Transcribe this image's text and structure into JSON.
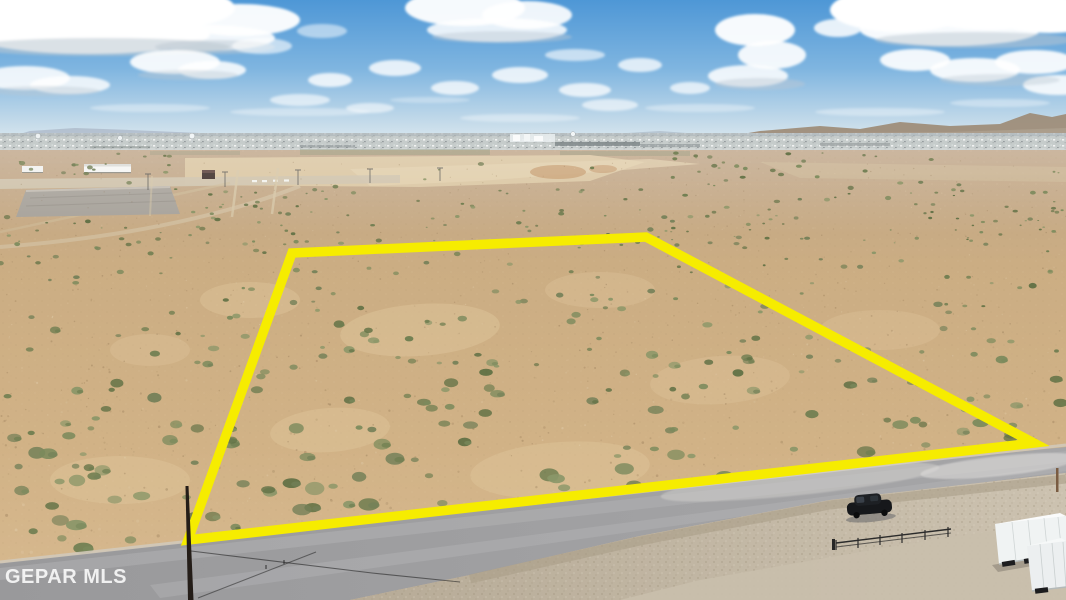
{
  "photo": {
    "alt": "aerial-drone-photo-of-vacant-desert-land-parcel",
    "width": 1066,
    "height": 600
  },
  "watermark": {
    "text": "GEPAR MLS",
    "color": "#ffffff",
    "opacity": 0.85
  },
  "parcel_outline": {
    "points": "292,253 646,237 1034,443 188,540",
    "color": "#F6EC00",
    "stroke_width": 9.5
  },
  "colors": {
    "sky_top": "#4E97D6",
    "sky_mid": "#7FB5E0",
    "sky_low": "#C7DCEA",
    "sky_horizon": "#E6EFF4",
    "cloud_white": "#FFFFFF",
    "cloud_shadow": "#BCC8D2",
    "mountain_left": "#9FA8BA",
    "mountain_right": "#9C8A74",
    "city_light": "#CDD3D5",
    "city_dark": "#B6BCBA",
    "sand_far": "#BFA588",
    "sand_mid": "#CBAD83",
    "sand_near": "#D7B98F",
    "cleared_pad": "#DAC5A0",
    "paved_pad": "#A7A29A",
    "road_asphalt_near": "#99999B",
    "road_asphalt_far": "#A6A6A8",
    "road_edge_dirt": "#D2C9BA",
    "gravel_shoulder": "#C2B6A2",
    "scrub_palette": [
      "#6E7D50",
      "#7B8A5C",
      "#5F7044",
      "#8A9668",
      "#748058"
    ],
    "speck_dark": "#8A6F4E",
    "speck_light": "#E8D7B8",
    "car_body": "#16181B",
    "trailer_white": "#F0F3F3",
    "pole_brown": "#241D18",
    "yellow_boundary": "#F6EC00"
  },
  "scene_labels": [
    "sky",
    "clouds",
    "distant-mountains",
    "city-skyline",
    "water-towers",
    "graded-development-area",
    "cleared-dirt-pad",
    "desert-scrubland",
    "parcel-boundary",
    "paved-road",
    "gravel-shoulder",
    "metal-fence",
    "parked-black-car",
    "white-box-trailers",
    "utility-pole",
    "power-lines",
    "mls-watermark"
  ]
}
